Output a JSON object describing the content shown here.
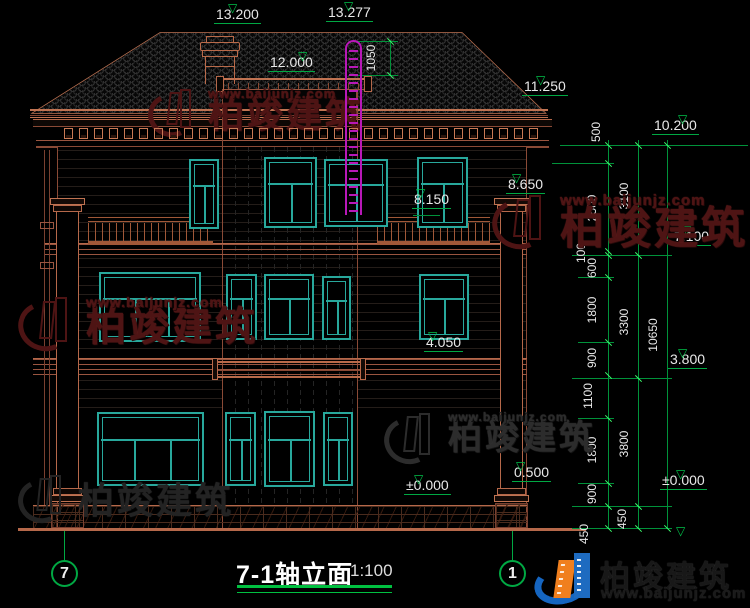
{
  "drawing": {
    "title": "7-1轴立面",
    "scale": "1:100",
    "axis_left_bubble": "7",
    "axis_right_bubble": "1"
  },
  "colors": {
    "building_line": "#c07352",
    "window_frame": "#28a89c",
    "dimension_green": "#00a843",
    "ladder_magenta": "#b818b8",
    "ground_line": "#b5684a"
  },
  "elevation_markers": [
    {
      "label": "13.200",
      "x": 214,
      "y": 6,
      "w": 68,
      "tri": 14,
      "align": "left"
    },
    {
      "label": "13.277",
      "x": 326,
      "y": 4,
      "w": 56,
      "tri": 18,
      "align": "left"
    },
    {
      "label": "12.000",
      "x": 268,
      "y": 54,
      "w": 62,
      "tri": 30,
      "align": "left"
    },
    {
      "label": "11.250",
      "x": 522,
      "y": 78,
      "w": 56,
      "tri": 14,
      "align": "left"
    },
    {
      "label": "10.200",
      "x": 652,
      "y": 117,
      "w": 96,
      "tri": 26,
      "align": "right"
    },
    {
      "label": "8.650",
      "x": 506,
      "y": 176,
      "w": 46,
      "tri": 6,
      "align": "left"
    },
    {
      "label": "8.150",
      "x": 412,
      "y": 191,
      "w": 48,
      "tri": 4,
      "align": "left"
    },
    {
      "label": "7.100",
      "x": 672,
      "y": 228,
      "w": 76,
      "tri": 10,
      "align": "right"
    },
    {
      "label": "4.050",
      "x": 424,
      "y": 334,
      "w": 66,
      "tri": 4,
      "align": "left"
    },
    {
      "label": "3.800",
      "x": 668,
      "y": 351,
      "w": 80,
      "tri": 10,
      "align": "right"
    },
    {
      "label": "±0.000",
      "x": 404,
      "y": 477,
      "w": 66,
      "tri": 10,
      "align": "left"
    },
    {
      "label": "0.500",
      "x": 512,
      "y": 464,
      "w": 48,
      "tri": 4,
      "align": "left"
    },
    {
      "label": "±0.000",
      "x": 660,
      "y": 472,
      "w": 88,
      "tri": 16,
      "align": "right"
    }
  ],
  "extra_triangles": [
    {
      "x": 676,
      "y": 524
    }
  ],
  "linear_dims": [
    {
      "label": "1050",
      "x": 371,
      "y": 58
    },
    {
      "label": "500",
      "x": 596,
      "y": 132
    },
    {
      "label": "2500",
      "x": 592,
      "y": 208
    },
    {
      "label": "100",
      "x": 581,
      "y": 253
    },
    {
      "label": "600",
      "x": 592,
      "y": 268
    },
    {
      "label": "1800",
      "x": 592,
      "y": 310
    },
    {
      "label": "900",
      "x": 592,
      "y": 358
    },
    {
      "label": "1100",
      "x": 588,
      "y": 396
    },
    {
      "label": "1800",
      "x": 592,
      "y": 450
    },
    {
      "label": "900",
      "x": 592,
      "y": 494
    },
    {
      "label": "450",
      "x": 584,
      "y": 534
    },
    {
      "label": "3100",
      "x": 624,
      "y": 196
    },
    {
      "label": "3300",
      "x": 624,
      "y": 322
    },
    {
      "label": "3800",
      "x": 624,
      "y": 444
    },
    {
      "label": "450",
      "x": 622,
      "y": 519
    },
    {
      "label": "10650",
      "x": 653,
      "y": 335
    }
  ],
  "watermarks": {
    "brand": "柏竣建筑",
    "url": "www.baijunjz.com",
    "instances": [
      {
        "x": 148,
        "y": 86,
        "style": "red",
        "text_size": 36,
        "url_size": 13,
        "icon": 52
      },
      {
        "x": 492,
        "y": 192,
        "style": "red",
        "text_size": 44,
        "url_size": 15,
        "icon": 60
      },
      {
        "x": 18,
        "y": 294,
        "style": "red",
        "text_size": 40,
        "url_size": 14,
        "icon": 60
      },
      {
        "x": 384,
        "y": 410,
        "style": "gray",
        "text_size": 34,
        "url_size": 12,
        "icon": 56
      },
      {
        "x": 18,
        "y": 472,
        "style": "gray2",
        "text_size": 36,
        "url_size": 0,
        "icon": 52
      }
    ]
  },
  "logo": {
    "brand": "柏竣建筑",
    "url": "www.baijunjz.com"
  }
}
